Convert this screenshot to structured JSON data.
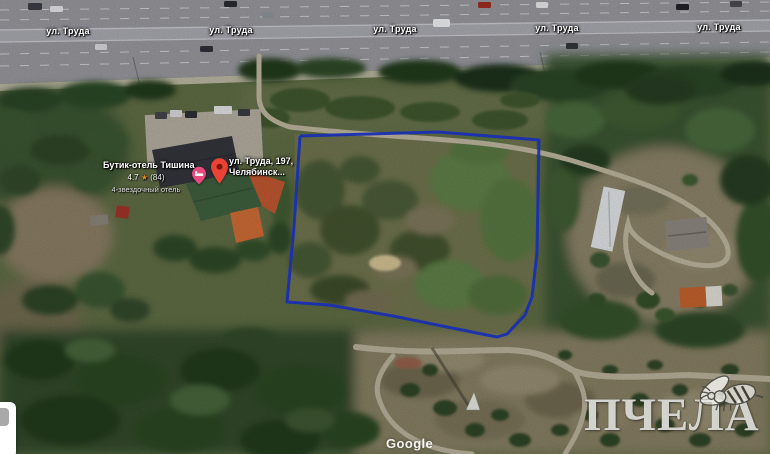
{
  "map": {
    "street_label": "ул. Труда",
    "watermark": "Google"
  },
  "place": {
    "name": "Бутик-отель Тишина",
    "rating": "4.7",
    "star": "★",
    "reviews": "(84)",
    "category": "4-звездочный отель"
  },
  "marker_info": {
    "line1": "ул. Труда, 197,",
    "line2": "Челябинск..."
  },
  "brand": {
    "text": "ПЧЕЛА"
  },
  "colors": {
    "plot_outline": "#1d36c8",
    "marker_red": "#ea4335",
    "hotel_pin_pink": "#e84a7f",
    "star_orange": "#e8871e"
  }
}
